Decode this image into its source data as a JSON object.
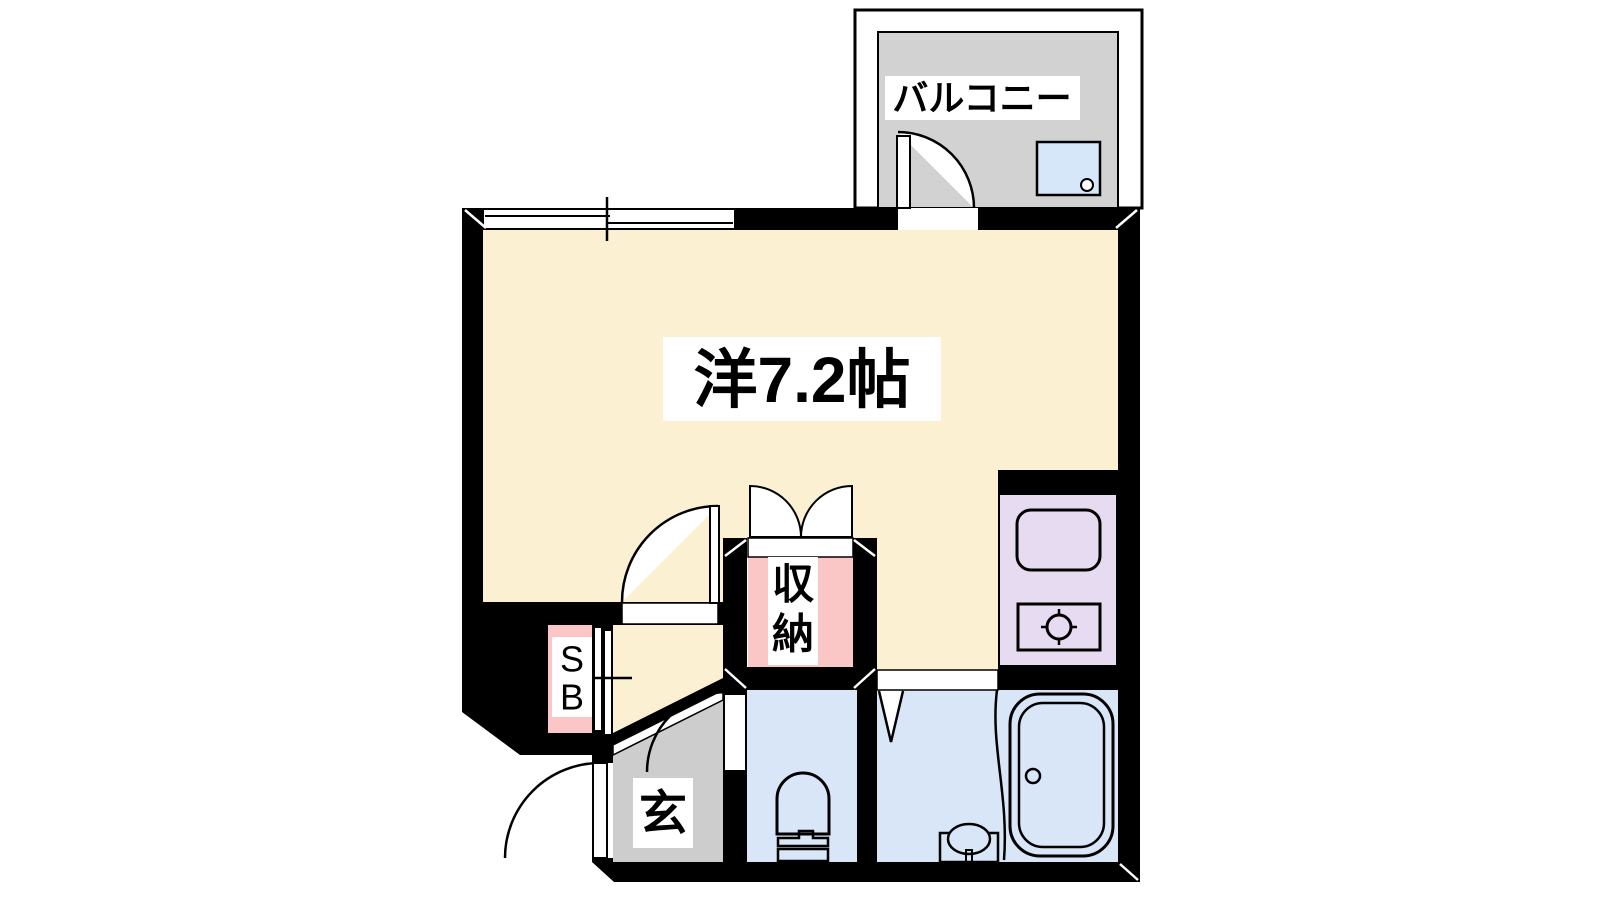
{
  "floorplan": {
    "labels": {
      "balcony": "バルコニー",
      "main_room": "洋7.2帖",
      "storage_line1": "収",
      "storage_line2": "納",
      "shoebox_line1": "S",
      "shoebox_line2": "B",
      "entrance": "玄"
    },
    "colors": {
      "wall": "#000000",
      "room_cream": "#FBF0D2",
      "balcony_grey": "#D2D2D2",
      "entrance_grey": "#CDCDCD",
      "storage_pink": "#FAC6C6",
      "wet_blue": "#D9E6F7",
      "kitchen_lavender": "#E7DBF1",
      "washer_blue": "#D6E7FA",
      "label_bg": "#FFFFFF"
    }
  }
}
